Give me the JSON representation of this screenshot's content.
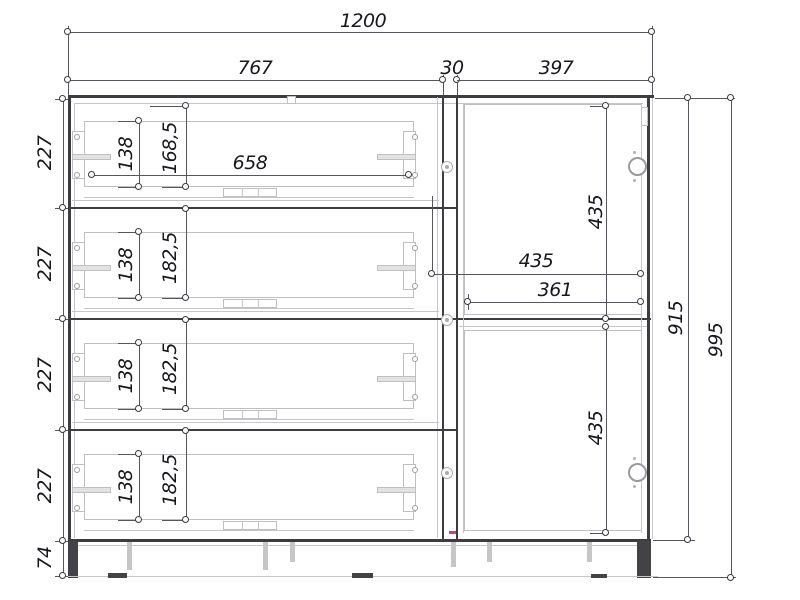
{
  "drawing": {
    "kind": "cabinet-front-elevation",
    "colors": {
      "line_dark": "#3d3d41",
      "line_light": "#c6c6c8",
      "dimension_line": "#55555c",
      "text": "#17181d",
      "accent_mark": "#d63a8e"
    },
    "labels": {
      "overall_width": "1200",
      "drawer_section_width": "767",
      "partition_width": "30",
      "door_section_width": "397",
      "drawer_pitch": "227",
      "plinth_height": "74",
      "drawer_box_height": "138",
      "top_drawer_front_height": "168,5",
      "drawer_front_height": "182,5",
      "drawer_box_width": "658",
      "door_height": "435",
      "door_width": "435",
      "door_inner_width": "361",
      "carcass_height": "915",
      "overall_height": "995"
    }
  }
}
